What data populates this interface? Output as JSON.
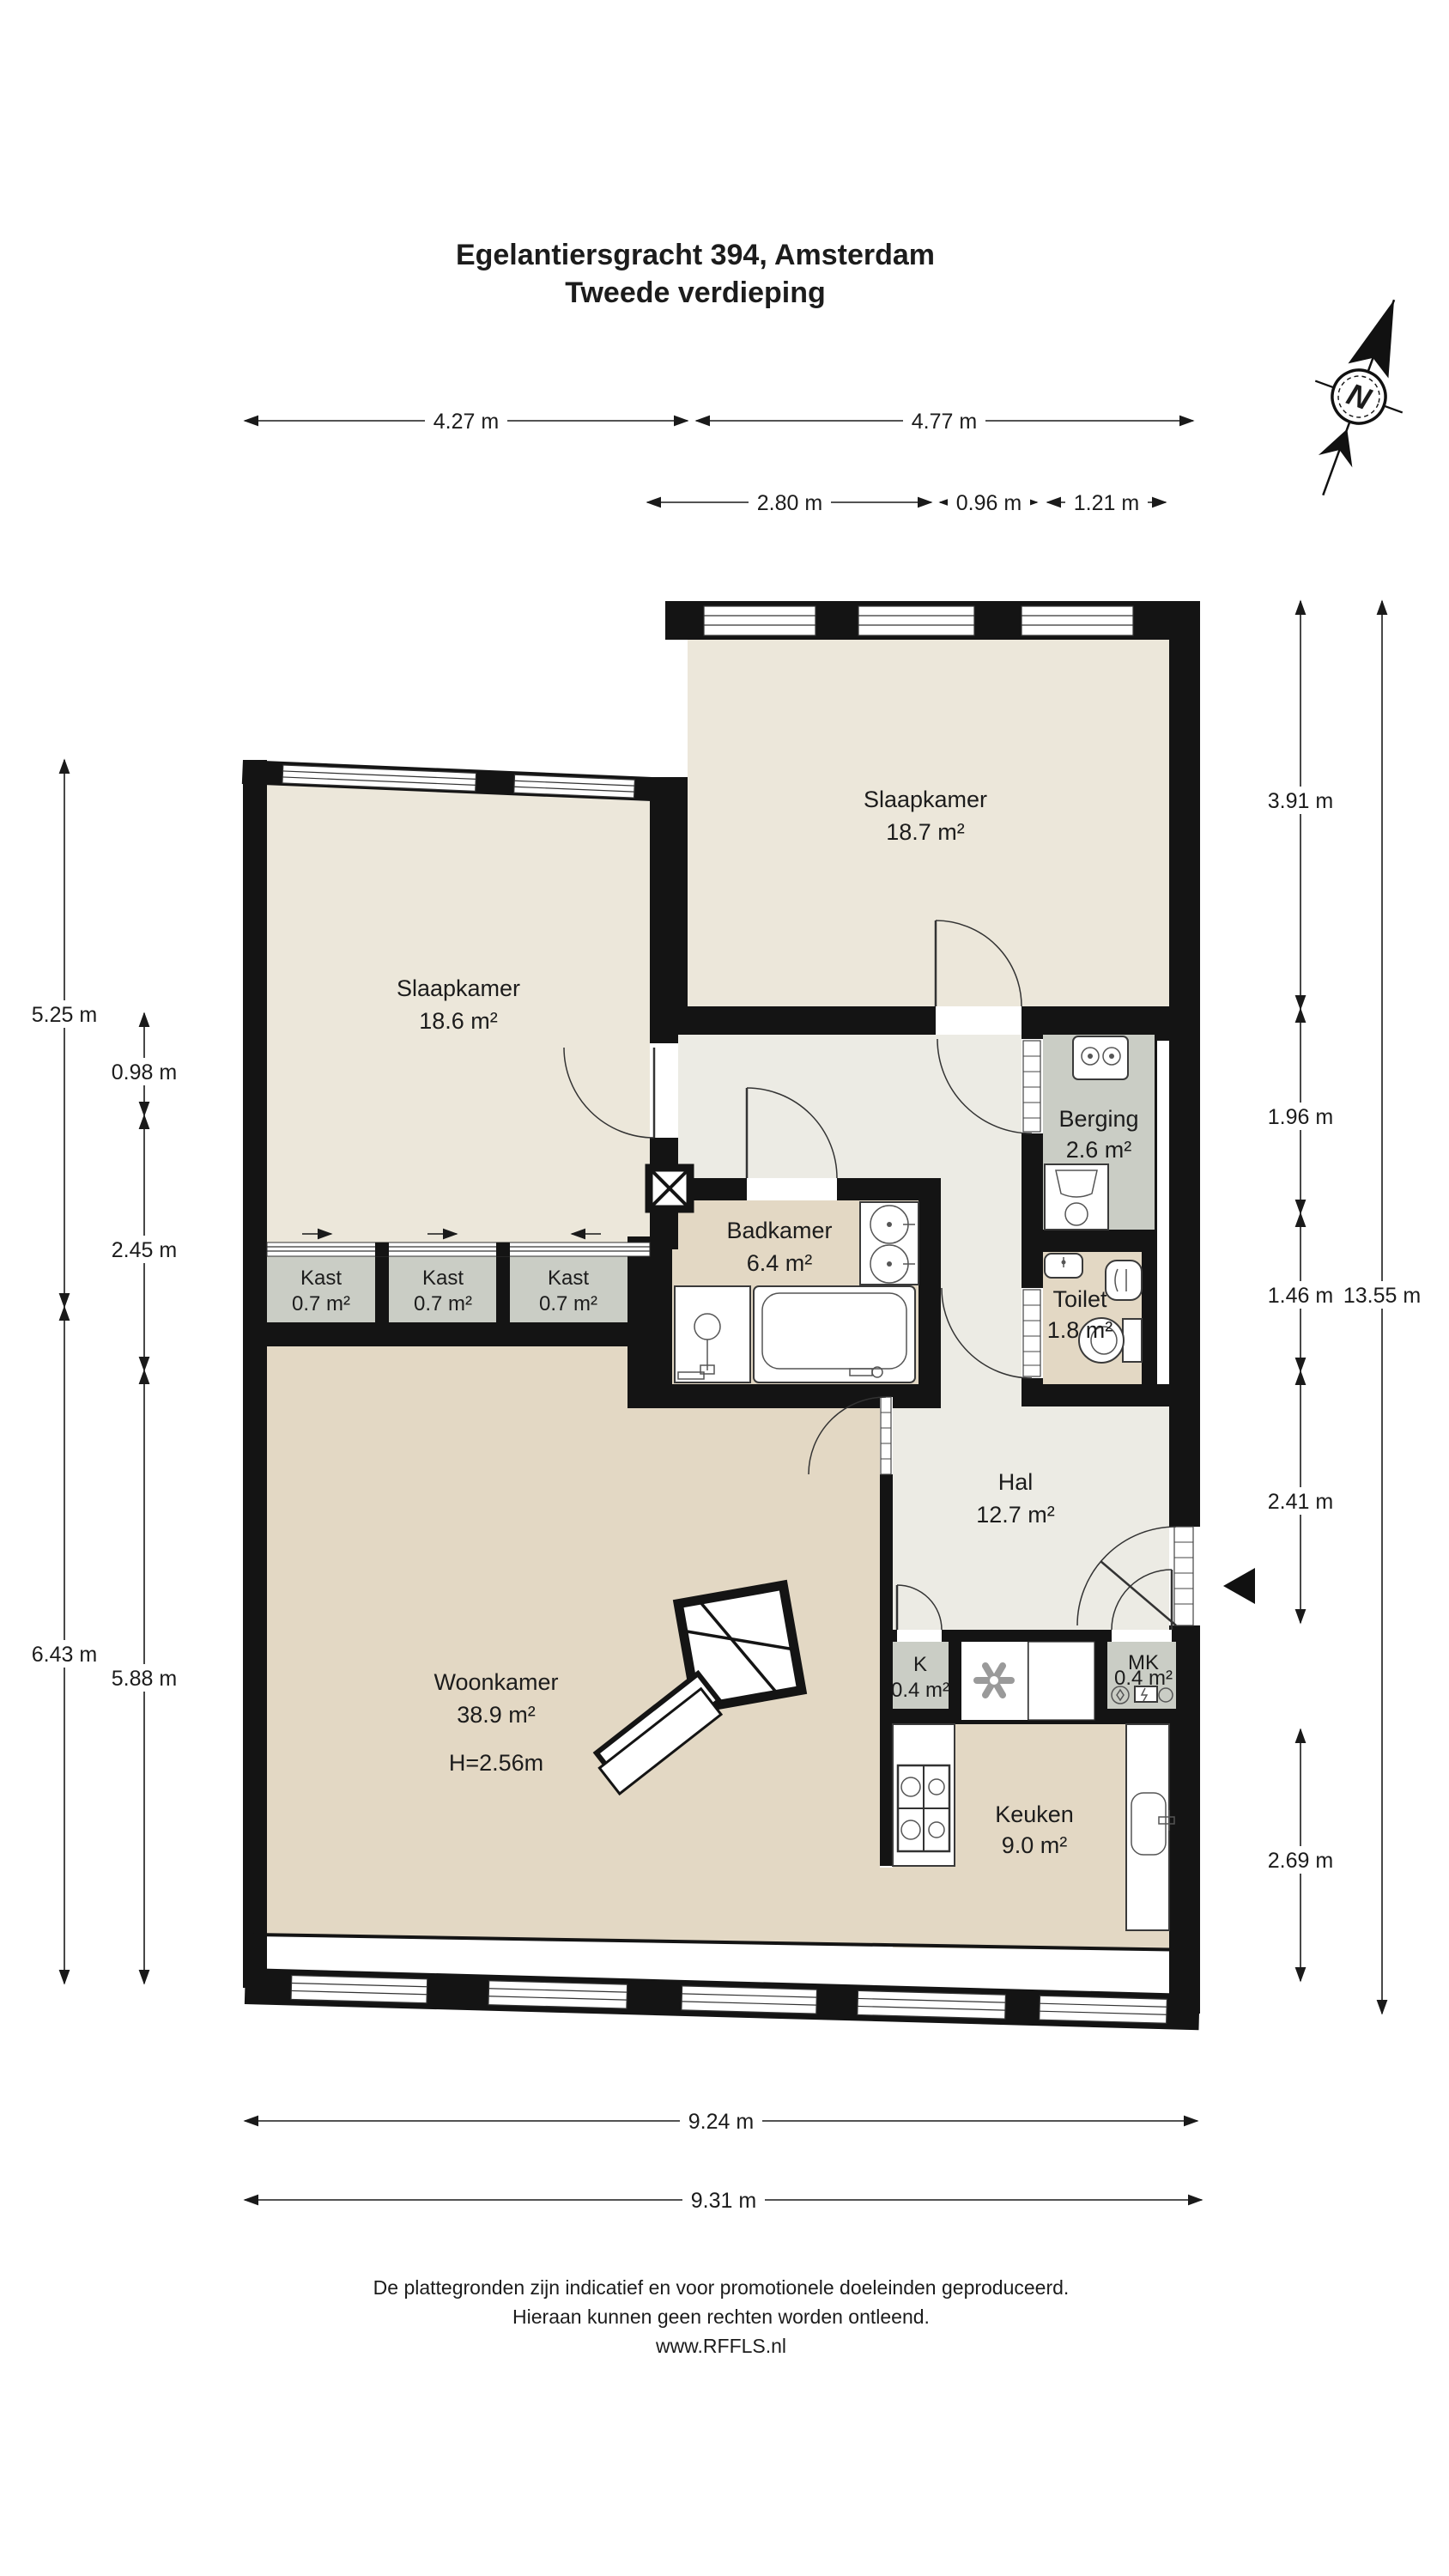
{
  "title": {
    "line1": "Egelantiersgracht 394, Amsterdam",
    "line2": "Tweede verdieping"
  },
  "compass": {
    "label": "N"
  },
  "rooms": {
    "slaapkamer1": {
      "name": "Slaapkamer",
      "area": "18.7 m²"
    },
    "slaapkamer2": {
      "name": "Slaapkamer",
      "area": "18.6 m²"
    },
    "berging": {
      "name": "Berging",
      "area": "2.6 m²"
    },
    "badkamer": {
      "name": "Badkamer",
      "area": "6.4 m²"
    },
    "toilet": {
      "name": "Toilet",
      "area": "1.8 m²"
    },
    "hal": {
      "name": "Hal",
      "area": "12.7 m²"
    },
    "woonkamer": {
      "name": "Woonkamer",
      "area": "38.9 m²",
      "ceiling_height": "H=2.56m"
    },
    "kast1": {
      "name": "Kast",
      "area": "0.7 m²"
    },
    "kast2": {
      "name": "Kast",
      "area": "0.7 m²"
    },
    "kast3": {
      "name": "Kast",
      "area": "0.7 m²"
    },
    "k": {
      "name": "K",
      "area": "0.4 m²"
    },
    "mk": {
      "name": "MK",
      "area": "0.4 m²"
    },
    "keuken": {
      "name": "Keuken",
      "area": "9.0 m²"
    }
  },
  "dimensions": {
    "top_row1": [
      {
        "label": "4.27 m"
      },
      {
        "label": "4.77 m"
      }
    ],
    "top_row2": [
      {
        "label": "2.80 m"
      },
      {
        "label": "0.96 m"
      },
      {
        "label": "1.21 m"
      }
    ],
    "left": [
      {
        "label": "5.25 m"
      },
      {
        "label": "6.43 m"
      },
      {
        "label": "0.98 m"
      },
      {
        "label": "2.45 m"
      },
      {
        "label": "5.88 m"
      }
    ],
    "right": [
      {
        "label": "3.91 m"
      },
      {
        "label": "1.96 m"
      },
      {
        "label": "1.46 m"
      },
      {
        "label": "2.41 m"
      },
      {
        "label": "2.69 m"
      },
      {
        "label": "13.55 m"
      }
    ],
    "bottom": [
      {
        "label": "9.24 m"
      },
      {
        "label": "9.31 m"
      }
    ]
  },
  "footer": {
    "line1": "De plattegronden zijn indicatief en voor promotionele doeleinden geproduceerd.",
    "line2": "Hieraan kunnen geen rechten worden ontleend.",
    "line3": "www.RFFLS.nl"
  },
  "colors": {
    "wall": "#141414",
    "floor_bedroom": "#ECE7DA",
    "floor_hall": "#ECEBE4",
    "floor_living": "#E3D8C4",
    "floor_closet": "#CACDC5",
    "dimension_line": "#1A1A1A"
  }
}
